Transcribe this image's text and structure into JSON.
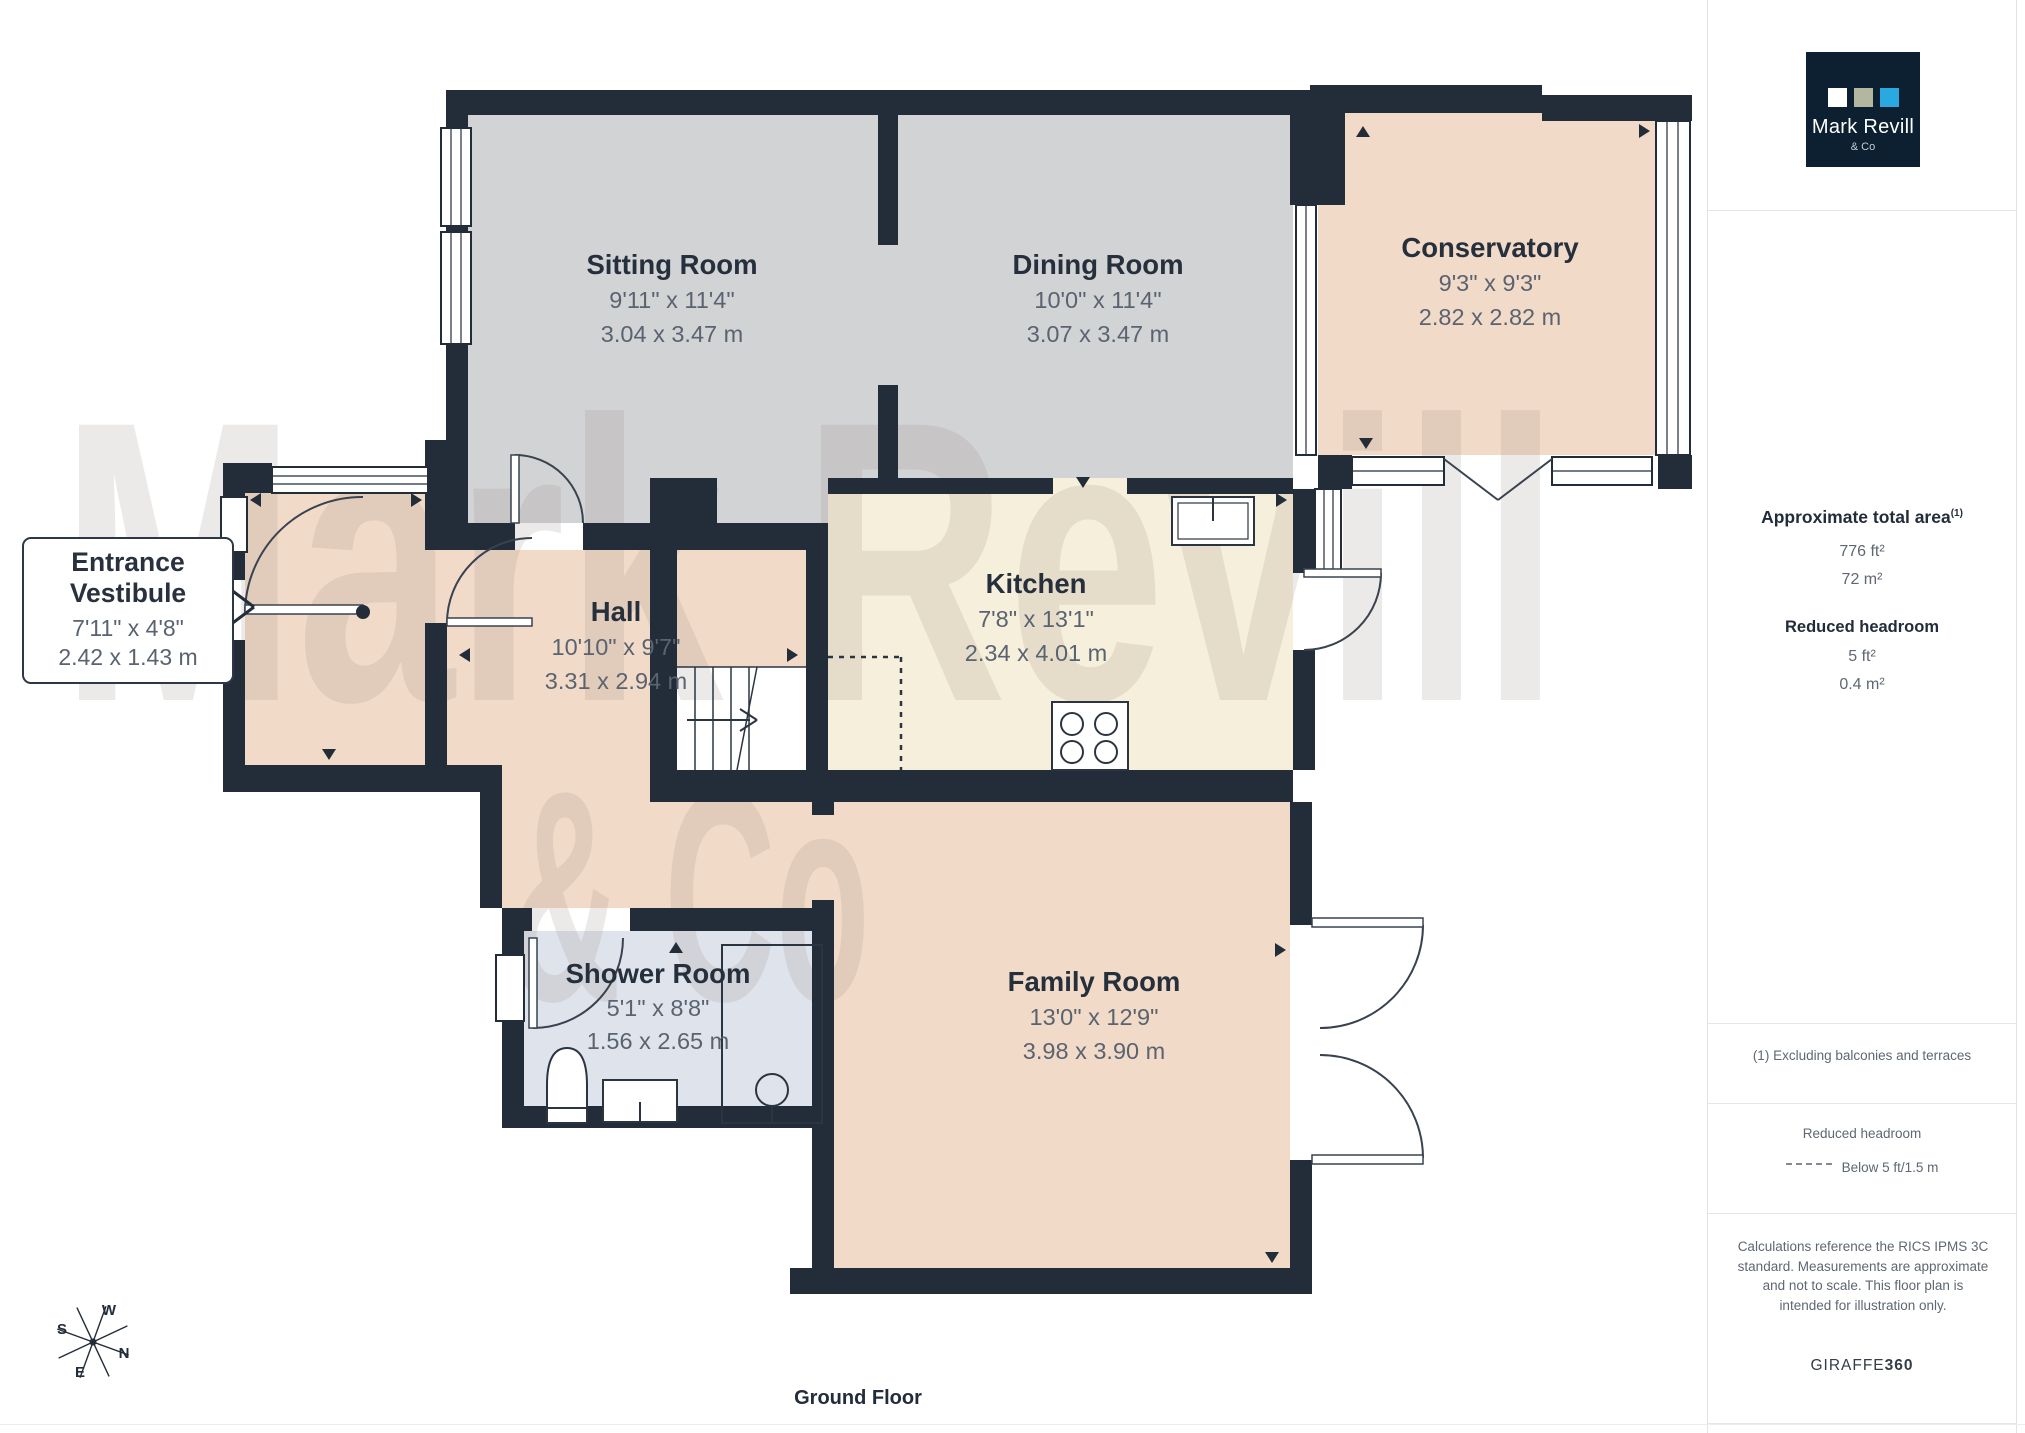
{
  "palette": {
    "wall": "#232d3a",
    "room_gray": "#d2d3d5",
    "room_peach": "#f2dac8",
    "room_cream": "#f6efdb",
    "room_shower": "#dfe3ec",
    "logo_navy": "#0c2032",
    "logo_square_white": "#ffffff",
    "logo_square_sage": "#b3b79e",
    "logo_square_blue": "#2aa9e0"
  },
  "brand": {
    "logo_line1": "Mark Revill",
    "logo_line2": "& Co"
  },
  "sidebar": {
    "area_title": "Approximate total area",
    "area_title_sup": "(1)",
    "area_ft": "776 ft²",
    "area_m": "72 m²",
    "reduced_title": "Reduced headroom",
    "reduced_ft": "5 ft²",
    "reduced_m": "0.4 m²",
    "footnote": "(1) Excluding balconies and terraces",
    "legend_title": "Reduced headroom",
    "legend_item": "Below 5 ft/1.5 m",
    "disclaimer": "Calculations reference the RICS IPMS 3C standard. Measurements are approximate and not to scale. This floor plan is intended for illustration only.",
    "giraffe_regular": "GIRAFFE",
    "giraffe_bold": "360"
  },
  "floorplan": {
    "title": "Ground Floor",
    "watermark_line1": "Mark Revill",
    "watermark_line2": "& Co",
    "compass": {
      "n": "N",
      "s": "S",
      "e": "E",
      "w": "W"
    },
    "rooms": [
      {
        "id": "sitting",
        "name": "Sitting Room",
        "imperial": "9'11\" x 11'4\"",
        "metric": "3.04 x 3.47 m"
      },
      {
        "id": "dining",
        "name": "Dining Room",
        "imperial": "10'0\" x 11'4\"",
        "metric": "3.07 x 3.47 m"
      },
      {
        "id": "conservatory",
        "name": "Conservatory",
        "imperial": "9'3\" x 9'3\"",
        "metric": "2.82 x 2.82 m"
      },
      {
        "id": "entrance",
        "name_line1": "Entrance",
        "name_line2": "Vestibule",
        "imperial": "7'11\" x 4'8\"",
        "metric": "2.42 x 1.43 m"
      },
      {
        "id": "hall",
        "name": "Hall",
        "imperial": "10'10\" x 9'7\"",
        "metric": "3.31 x 2.94 m"
      },
      {
        "id": "kitchen",
        "name": "Kitchen",
        "imperial": "7'8\" x 13'1\"",
        "metric": "2.34 x 4.01 m"
      },
      {
        "id": "shower",
        "name": "Shower Room",
        "imperial": "5'1\" x 8'8\"",
        "metric": "1.56 x 2.65 m"
      },
      {
        "id": "family",
        "name": "Family Room",
        "imperial": "13'0\" x 12'9\"",
        "metric": "3.98 x 3.90 m"
      }
    ]
  }
}
